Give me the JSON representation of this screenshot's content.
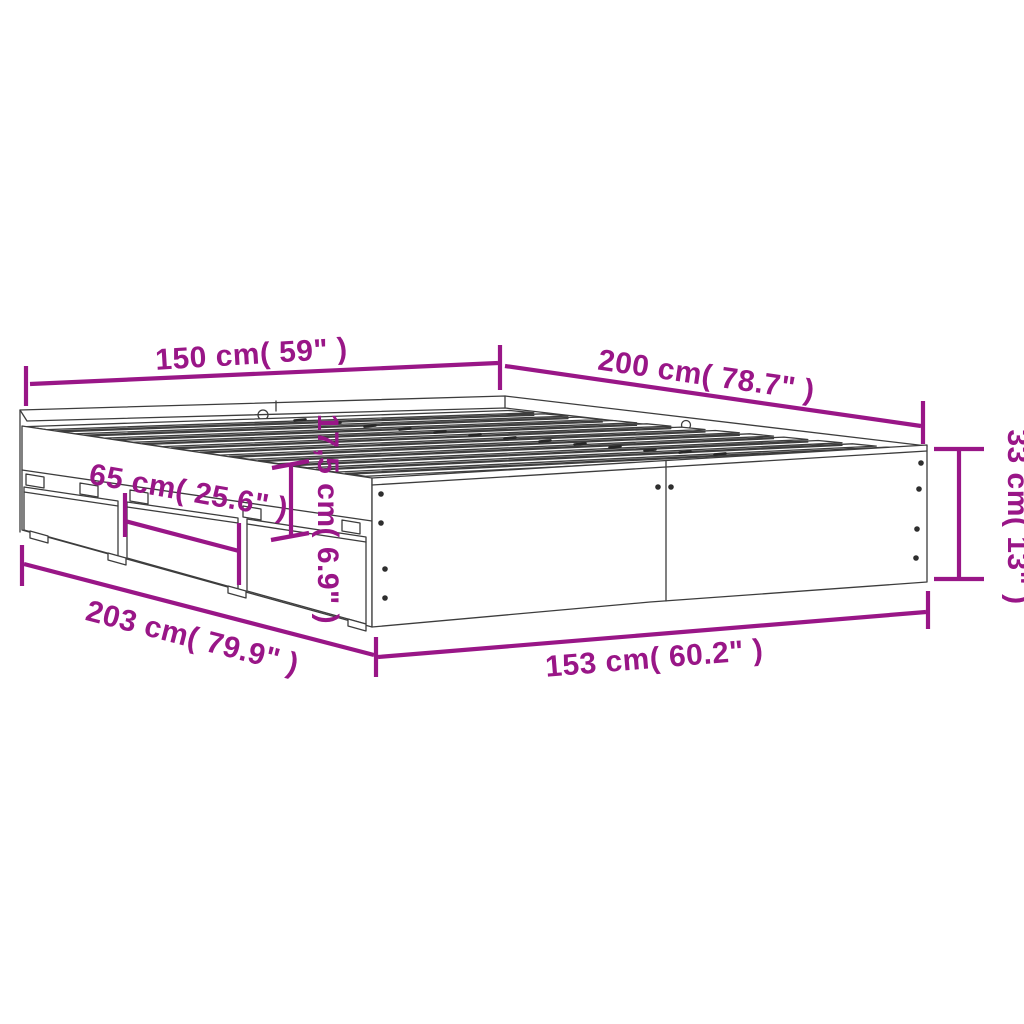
{
  "colors": {
    "background": "#ffffff",
    "accent": "#991687",
    "line": "#3d3d3d"
  },
  "diagram": {
    "kind": "product-dimension-diagram",
    "subject": "bed-frame-with-drawers-and-slats"
  },
  "dims": {
    "head_width": "150 cm( 59\" )",
    "side_length": "200 cm( 78.7\" )",
    "frame_height": "33 cm( 13\" )",
    "drawer_width": "65 cm( 25.6\" )",
    "drawer_height": "17,5 cm( 6.9\" )",
    "total_length": "203 cm( 79.9\" )",
    "total_width": "153 cm( 60.2\" )"
  }
}
